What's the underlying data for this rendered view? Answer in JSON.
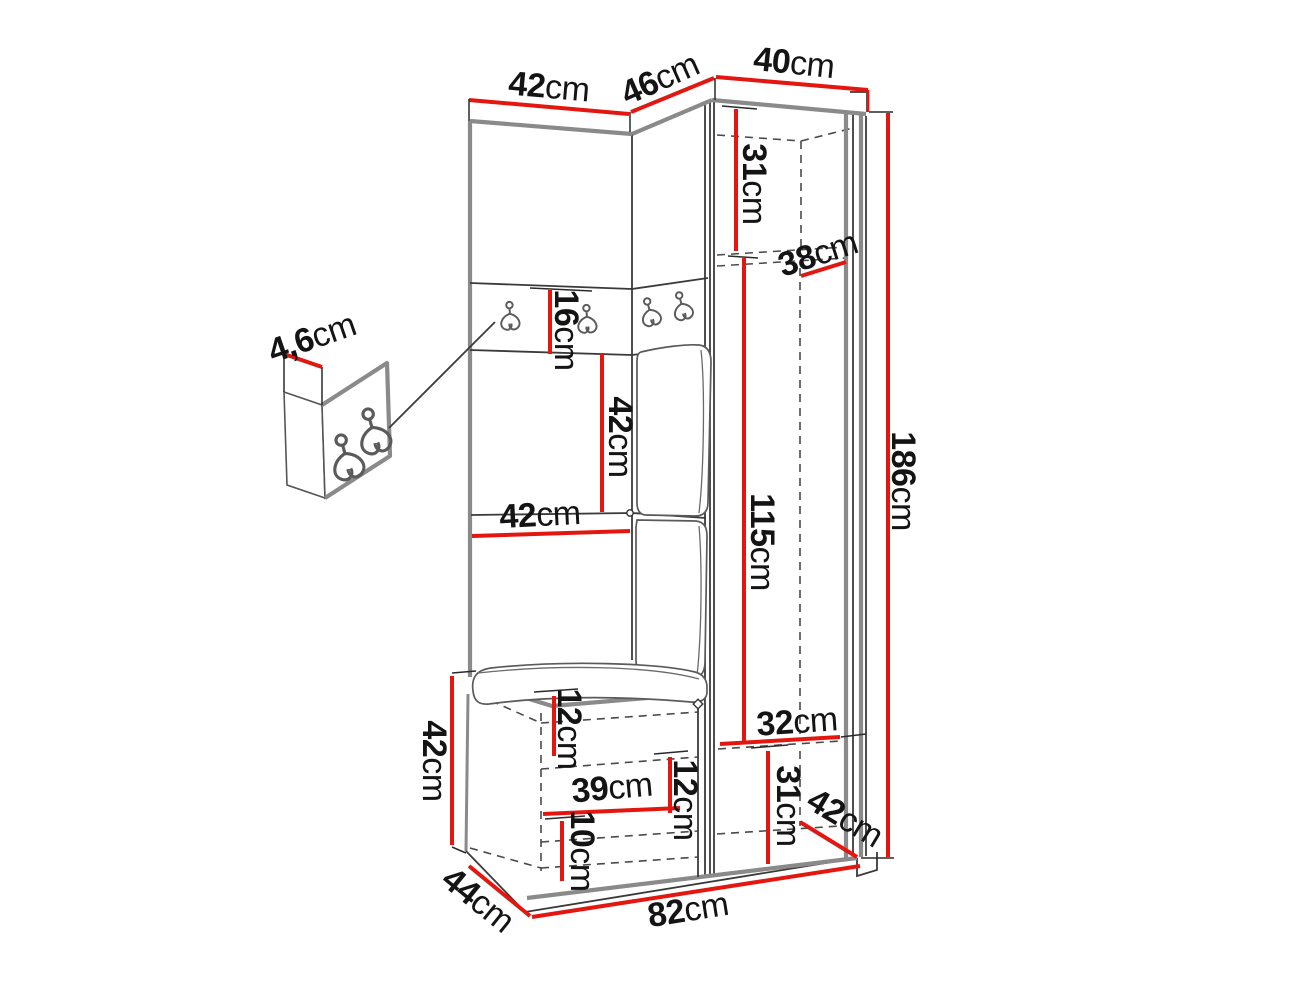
{
  "diagram": {
    "description": "Hallway furniture set (corner wardrobe with coat hooks and bench) dimension drawing",
    "colors": {
      "dimension_line": "#e31710",
      "drawing_edge": "#8a8a8a",
      "drawing_line": "#3a3a3a",
      "label_text": "#141414",
      "background": "#ffffff"
    },
    "dimensions": {
      "top_left_width": {
        "value": "42",
        "unit": "cm"
      },
      "top_corner_width": {
        "value": "46",
        "unit": "cm"
      },
      "top_cabinet_width": {
        "value": "40",
        "unit": "cm"
      },
      "cabinet_upper_inner_height": {
        "value": "31",
        "unit": "cm"
      },
      "cabinet_inner_depth": {
        "value": "38",
        "unit": "cm"
      },
      "hook_panel_thickness": {
        "value": "4,6",
        "unit": "cm"
      },
      "hook_strip_height": {
        "value": "16",
        "unit": "cm"
      },
      "panel_mid_height": {
        "value": "42",
        "unit": "cm"
      },
      "panel_mid_width": {
        "value": "42",
        "unit": "cm"
      },
      "cabinet_inner_height": {
        "value": "115",
        "unit": "cm"
      },
      "total_height": {
        "value": "186",
        "unit": "cm"
      },
      "bench_height": {
        "value": "42",
        "unit": "cm"
      },
      "bench_top_clearance": {
        "value": "12",
        "unit": "cm"
      },
      "cabinet_lower_inner_width": {
        "value": "32",
        "unit": "cm"
      },
      "bench_inner_width": {
        "value": "39",
        "unit": "cm"
      },
      "bench_shelf_spacing": {
        "value": "12",
        "unit": "cm"
      },
      "cabinet_lower_inner_height": {
        "value": "31",
        "unit": "cm"
      },
      "cabinet_bottom_depth": {
        "value": "42",
        "unit": "cm"
      },
      "plinth_height": {
        "value": "10",
        "unit": "cm"
      },
      "unit_depth": {
        "value": "44",
        "unit": "cm"
      },
      "total_width": {
        "value": "82",
        "unit": "cm"
      }
    }
  }
}
